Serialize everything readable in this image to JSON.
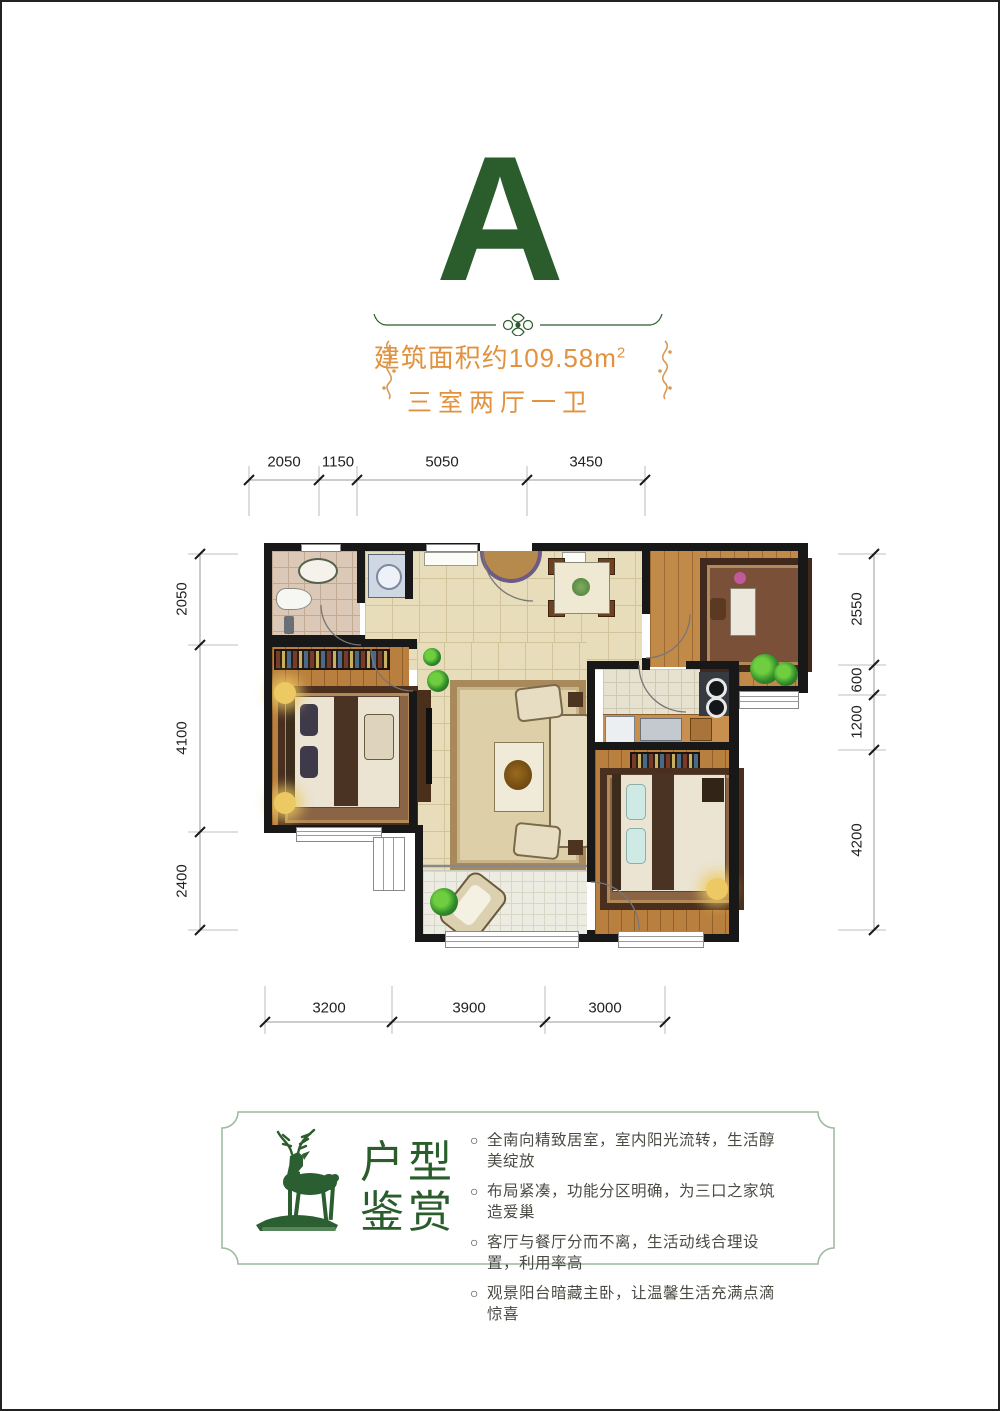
{
  "unit": {
    "letter": "A"
  },
  "summary": {
    "area_prefix": "建筑面积约109.58m",
    "area_sup": "2",
    "layout": "三室两厅一卫"
  },
  "dimensions": {
    "top": [
      "2050",
      "1150",
      "5050",
      "3450"
    ],
    "left": [
      "2050",
      "4100",
      "2400"
    ],
    "right": [
      "2550",
      "600",
      "1200",
      "4200"
    ],
    "bottom": [
      "3200",
      "3900",
      "3000"
    ]
  },
  "appreciation": {
    "title_line1": "户型",
    "title_line2": "鉴赏",
    "bullet_marker": "○",
    "bullets": [
      "全南向精致居室，室内阳光流转，生活醇美绽放",
      "布局紧凑，功能分区明确，为三口之家筑造爱巢",
      "客厅与餐厅分而不离，生活动线合理设置，利用率高",
      "观景阳台暗藏主卧，让温馨生活充满点滴惊喜"
    ]
  },
  "colors": {
    "brand_green": "#2a5c2c",
    "accent_orange": "#e2913e",
    "wall": "#181818",
    "box_border_green": "#9cb89c"
  }
}
